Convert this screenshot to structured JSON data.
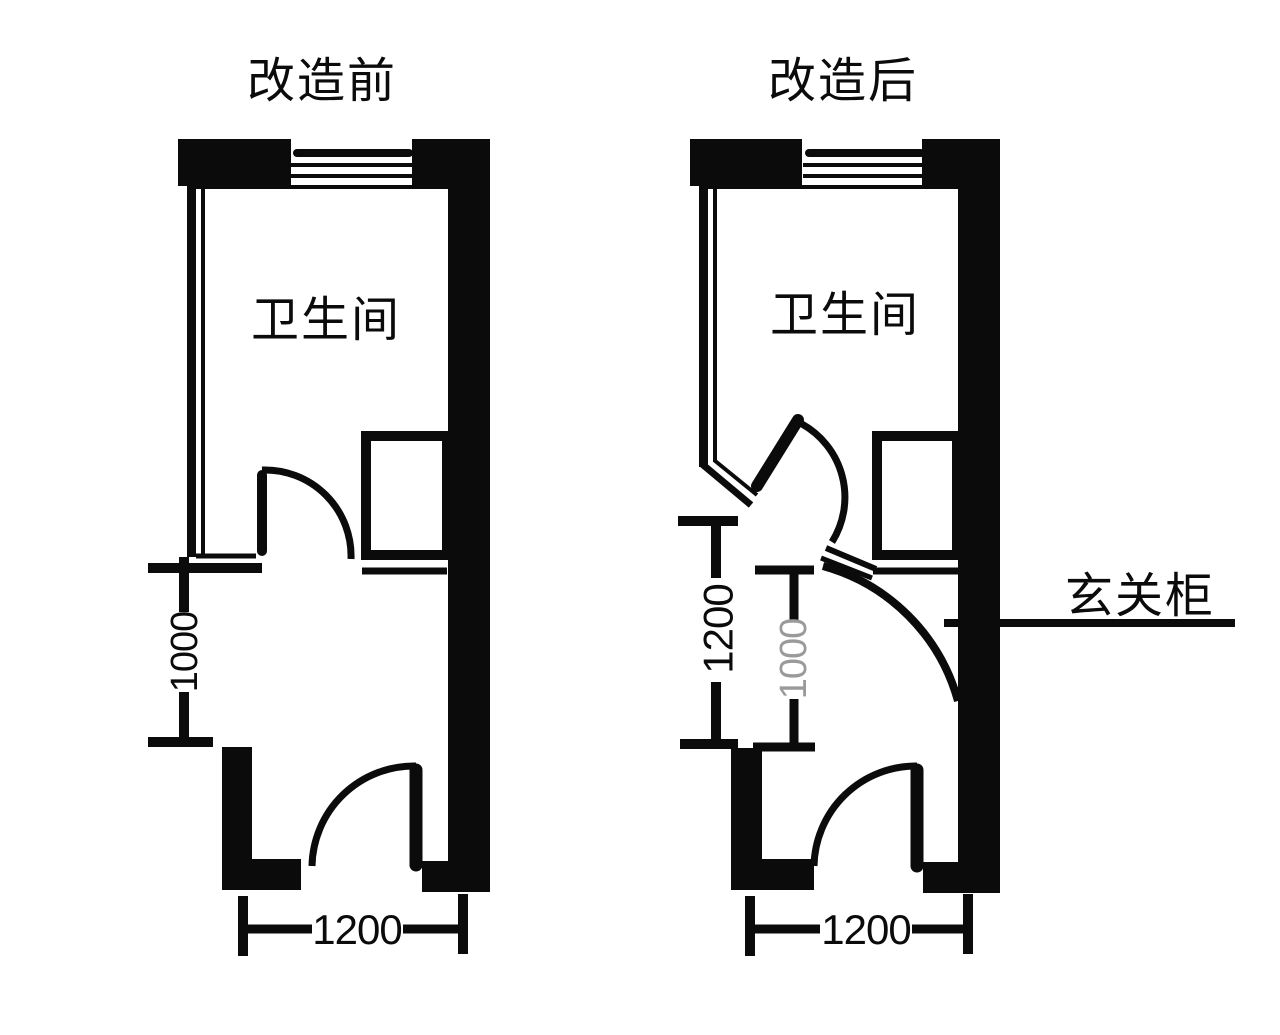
{
  "colors": {
    "ink": "#0b0b0b",
    "background": "#ffffff",
    "dim_muted": "#9a9a9a"
  },
  "plans": {
    "before": {
      "title": "改造前",
      "room_label": "卫生间",
      "dims": {
        "hallway_depth": "1000",
        "entry_width": "1200"
      }
    },
    "after": {
      "title": "改造后",
      "room_label": "卫生间",
      "dims": {
        "corridor_depth": "1200",
        "hallway_depth": "1000",
        "entry_width": "1200"
      },
      "callout": "玄关柜"
    }
  }
}
